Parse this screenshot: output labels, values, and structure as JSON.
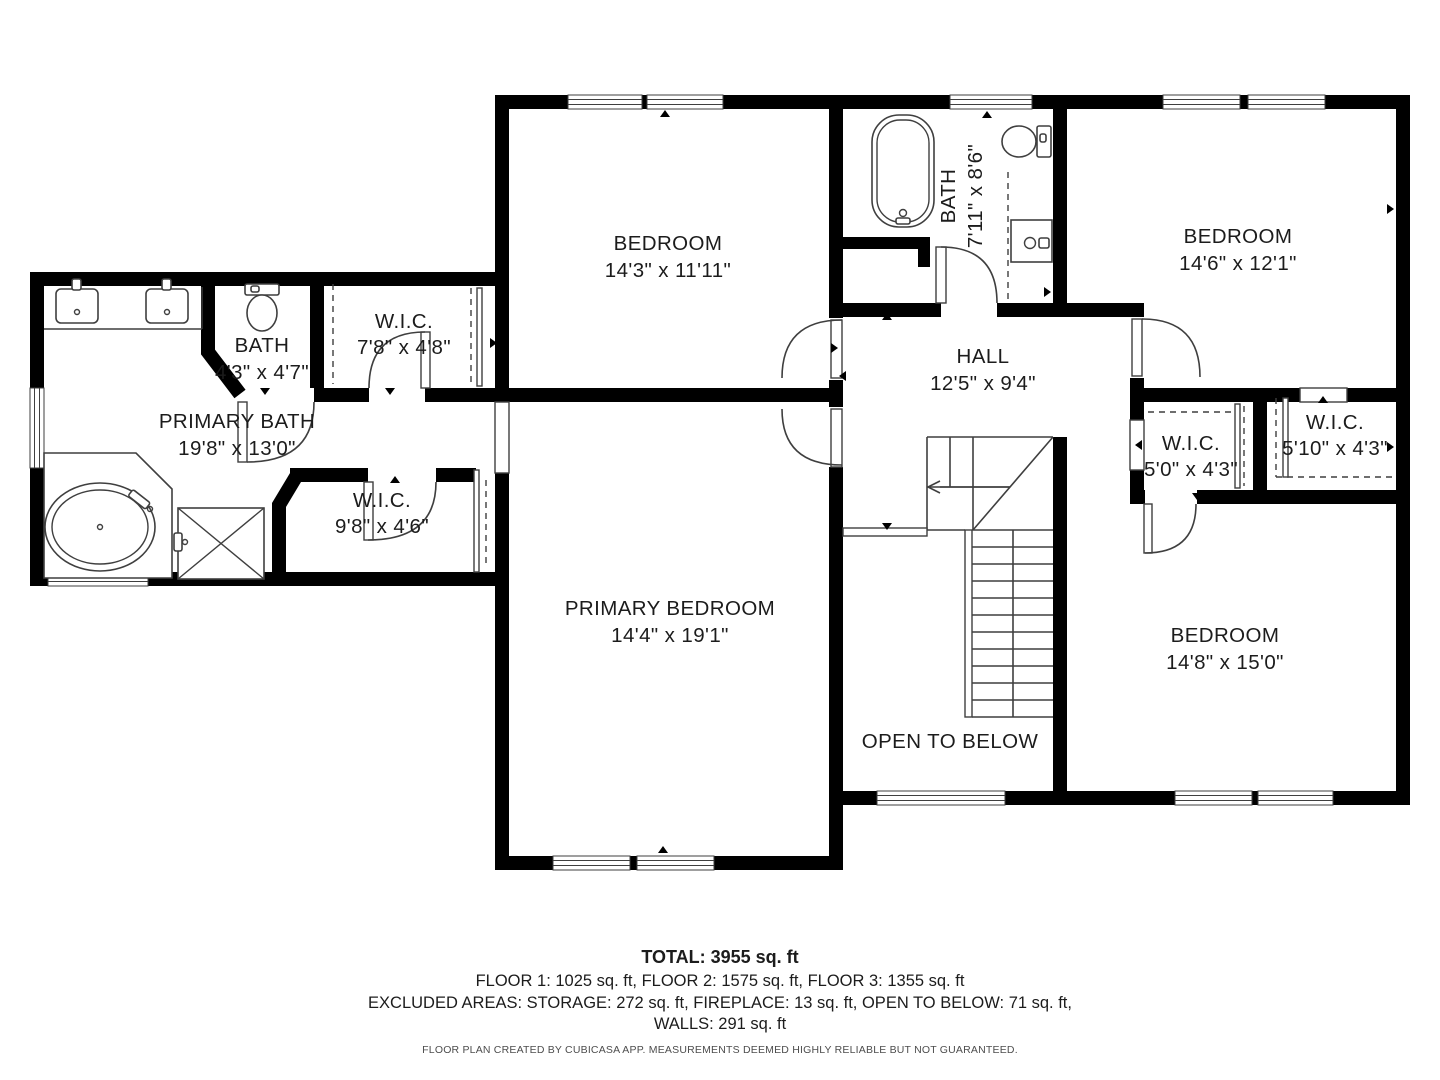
{
  "plan": {
    "rooms": {
      "bedroom1": {
        "name": "BEDROOM",
        "dims": "14'3\" x 11'11\""
      },
      "bath2": {
        "name": "BATH",
        "dims": "7'11\" x 8'6\""
      },
      "bedroom2": {
        "name": "BEDROOM",
        "dims": "14'6\" x 12'1\""
      },
      "bath1": {
        "name": "BATH",
        "dims": "4'3\" x 4'7\""
      },
      "wic1": {
        "name": "W.I.C.",
        "dims": "7'8\" x 4'8\""
      },
      "primary_bath": {
        "name": "PRIMARY BATH",
        "dims": "19'8\" x 13'0\""
      },
      "hall": {
        "name": "HALL",
        "dims": "12'5\" x 9'4\""
      },
      "wic2": {
        "name": "W.I.C.",
        "dims": "9'8\" x 4'6\""
      },
      "wic3": {
        "name": "W.I.C.",
        "dims": "5'0\" x 4'3\""
      },
      "wic4": {
        "name": "W.I.C.",
        "dims": "5'10\" x 4'3\""
      },
      "primary_bedroom": {
        "name": "PRIMARY BEDROOM",
        "dims": "14'4\" x 19'1\""
      },
      "bedroom3": {
        "name": "BEDROOM",
        "dims": "14'8\" x 15'0\""
      },
      "open_to_below": {
        "name": "OPEN TO BELOW"
      }
    },
    "summary": {
      "total": "TOTAL: 3955 sq. ft",
      "floors": "FLOOR 1: 1025 sq. ft, FLOOR 2: 1575 sq. ft, FLOOR 3: 1355 sq. ft",
      "excluded": "EXCLUDED AREAS: STORAGE: 272 sq. ft, FIREPLACE: 13 sq. ft, OPEN TO BELOW: 71 sq. ft,",
      "walls": "WALLS: 291 sq. ft",
      "disclaimer": "FLOOR PLAN CREATED BY CUBICASA APP. MEASUREMENTS DEEMED HIGHLY RELIABLE BUT NOT GUARANTEED."
    },
    "colors": {
      "wall": "#000000",
      "fixture_line": "#3f3f3f",
      "label_text": "#1c1c1c",
      "background": "#ffffff"
    }
  }
}
